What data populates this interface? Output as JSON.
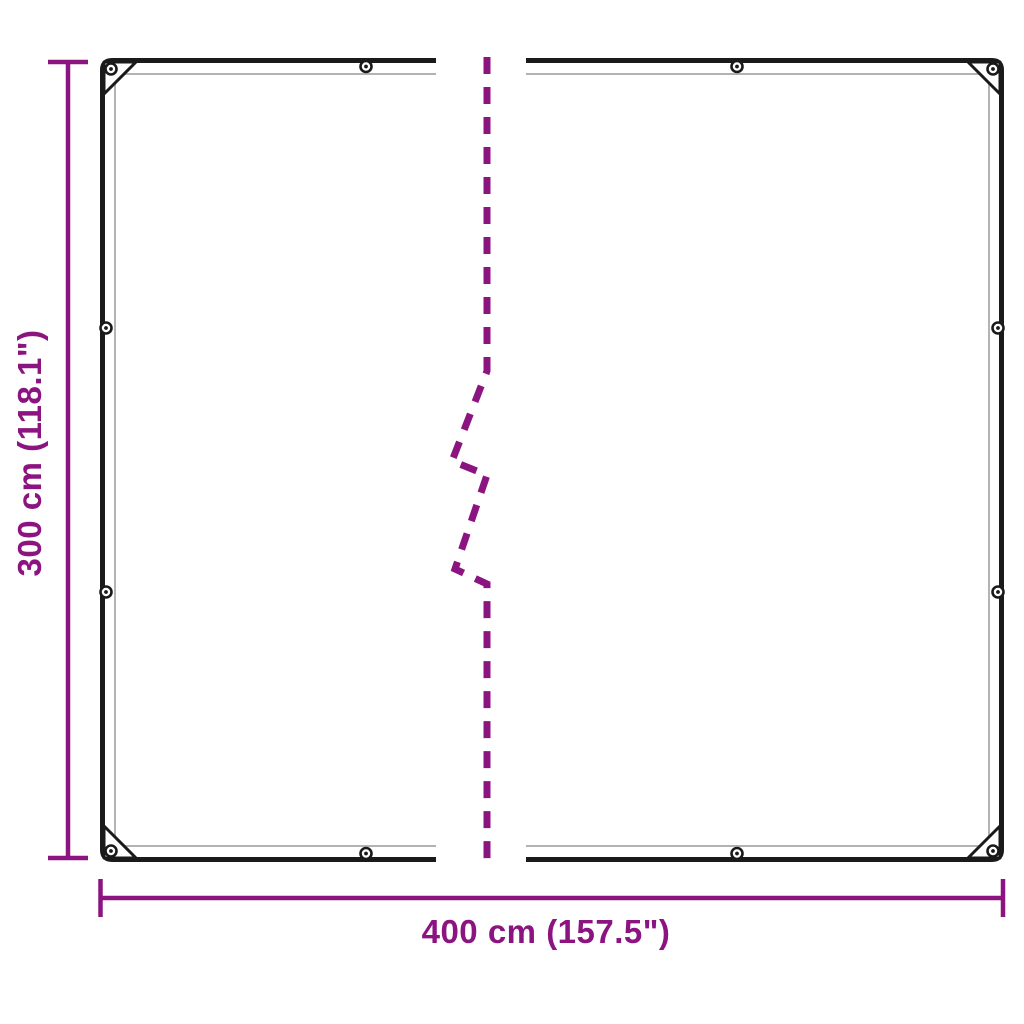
{
  "diagram": {
    "title": "tarpaulin-dimension-diagram",
    "width_label": "400 cm (157.5\")",
    "height_label": "300 cm (118.1\")",
    "width_cm": 400,
    "width_inches": 157.5,
    "height_cm": 300,
    "height_inches": 118.1,
    "colors": {
      "dimension": "#8C1480",
      "outline": "#1a1a1a",
      "seam": "#b3b3b3",
      "background": "#ffffff"
    }
  }
}
